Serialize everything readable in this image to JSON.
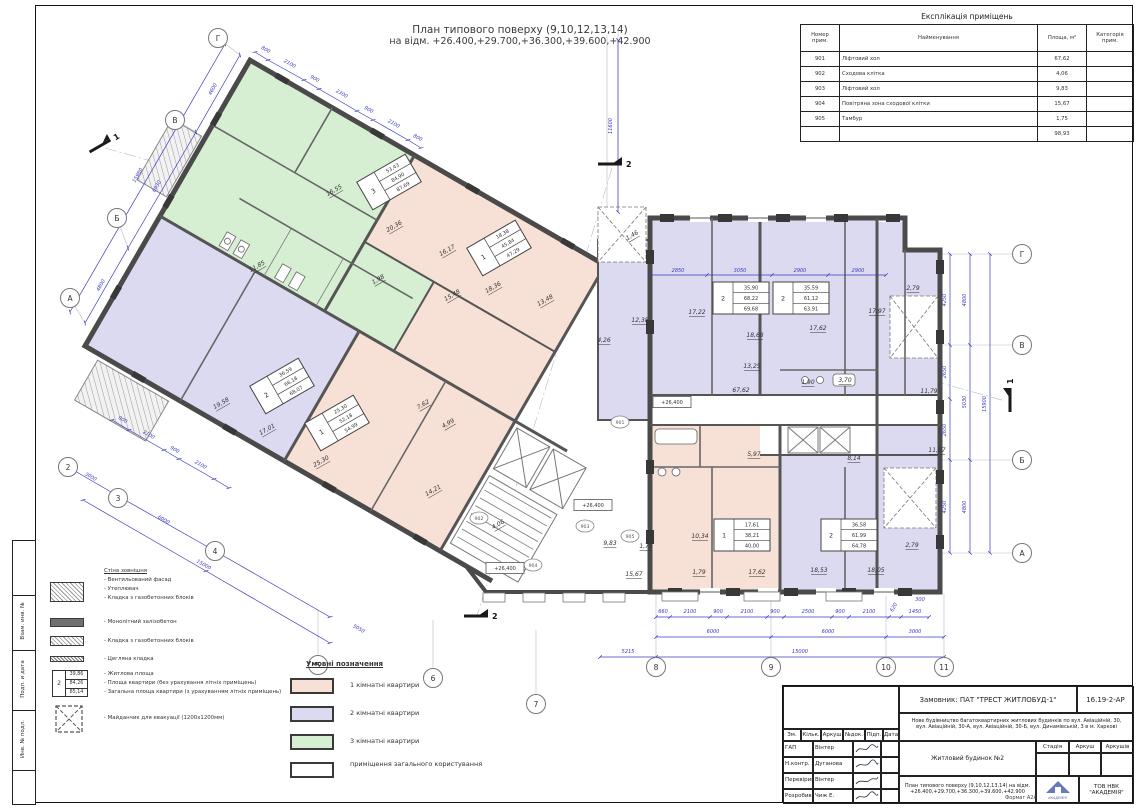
{
  "sheet": {
    "title_line1": "План типового поверху (9,10,12,13,14)",
    "title_line2": "на відм. +26.400,+29.700,+36.300,+39.600,+42.900"
  },
  "colors": {
    "one_room": "#f7e1d6",
    "two_room": "#dcdaf0",
    "three_room": "#d6efd2",
    "common": "#ffffff",
    "dimension": "#3a3ac0"
  },
  "explication": {
    "title": "Експлікація приміщень",
    "headers": [
      "Номер прим.",
      "Найменування",
      "Площа, м²",
      "Категорія прим."
    ],
    "rows": [
      {
        "num": "901",
        "name": "Ліфтовий хол",
        "area": "67,62",
        "cat": ""
      },
      {
        "num": "902",
        "name": "Сходова клітка",
        "area": "4,06",
        "cat": ""
      },
      {
        "num": "903",
        "name": "Ліфтовий хол",
        "area": "9,83",
        "cat": ""
      },
      {
        "num": "904",
        "name": "Повітряна зона сходової клітки",
        "area": "15,67",
        "cat": ""
      },
      {
        "num": "905",
        "name": "Тамбур",
        "area": "1,75",
        "cat": ""
      }
    ],
    "total": "98,93"
  },
  "wall_legend": {
    "heading": "Стіна зовнішня",
    "facade_lines": [
      "- Вентильований фасад",
      "- Утеплювач",
      "- Кладка з газобетонних блоків"
    ],
    "monolith": "- Монолітний залізобетон",
    "masonry": "- Кладка з газобетонних блоків",
    "brick": "- Цегляна кладка",
    "area_lines": [
      "- Житлова площа",
      "- Площа квартири (без урахування літніх приміщень)",
      "- Загальна площа квартири (з урахуванням літніх приміщень)"
    ],
    "evac": "- Майданчик для евакуації (1200х1200мм)",
    "sample_box": {
      "num": "2",
      "values": [
        "39,86",
        "84,26",
        "85,14"
      ]
    }
  },
  "area_legend": {
    "title": "Умовні позначення",
    "items": [
      {
        "label": "1 кімнатні квартири",
        "color": "#f7e1d6"
      },
      {
        "label": "2 кімнатні квартири",
        "color": "#dcdaf0"
      },
      {
        "label": "3 кімнатні квартири",
        "color": "#d6efd2"
      },
      {
        "label": "приміщення загального користування",
        "color": "#ffffff"
      }
    ]
  },
  "side_labels": [
    "Взам. инв. №",
    "Подп. и дата",
    "Инв. № подл."
  ],
  "title_block": {
    "customer": "Замовник: ПАТ \"ТРЕСТ ЖИТЛОБУД-1\"",
    "doc_code": "16.19-2-АР",
    "project_line1": "Нове будівництво багатоквартирних житлових будинків по вул. Авіаційній, 30,",
    "project_line2": "вул. Авіаційній, 30-А, вул. Авіаційній, 30-Б, вул. Динамівській, 3 в м. Харкові",
    "building": "Житловий будинок №2",
    "drawing_line1": "План типового поверху (9,10,12,13,14) на відм.",
    "drawing_line2": "+26.400,+29.700,+36.300,+39.600,+42.900",
    "org": "ТОВ НВК \"АКАДЕМІЯ\"",
    "logo_text": "АКАДЕМІЯ",
    "format": "Формат А2А",
    "stage_headers": [
      "Стадія",
      "Аркуш",
      "Аркушів"
    ],
    "rev_headers": [
      "Зм.",
      "Кільк.",
      "Аркуш",
      "№док.",
      "Підп.",
      "Дата"
    ],
    "signers": [
      {
        "role": "ГАП",
        "name": "Вінтер"
      },
      {
        "role": "Н.контр.",
        "name": "Дуганова"
      },
      {
        "role": "Перевірив",
        "name": "Вінтер"
      },
      {
        "role": "Розробив",
        "name": "Чиж Е."
      }
    ]
  },
  "plan": {
    "apartment_boxes": [
      {
        "num": "3",
        "values": [
          "53,43",
          "84,90",
          "87,69"
        ],
        "x": 389,
        "y": 182,
        "r": -30
      },
      {
        "num": "1",
        "values": [
          "18,38",
          "45,84",
          "47,29"
        ],
        "x": 499,
        "y": 248,
        "r": -30
      },
      {
        "num": "2",
        "values": [
          "36,59",
          "66,18",
          "68,07"
        ],
        "x": 282,
        "y": 386,
        "r": -30
      },
      {
        "num": "1",
        "values": [
          "25,30",
          "52,18",
          "54,99"
        ],
        "x": 337,
        "y": 423,
        "r": -30
      },
      {
        "num": "2",
        "values": [
          "35,90",
          "68,22",
          "69,68"
        ],
        "x": 741,
        "y": 298,
        "r": 0
      },
      {
        "num": "2",
        "values": [
          "35,59",
          "61,12",
          "63,91"
        ],
        "x": 801,
        "y": 298,
        "r": 0
      },
      {
        "num": "1",
        "values": [
          "17,61",
          "38,21",
          "40,00"
        ],
        "x": 742,
        "y": 535,
        "r": 0
      },
      {
        "num": "2",
        "values": [
          "36,58",
          "61,99",
          "64,78"
        ],
        "x": 849,
        "y": 535,
        "r": 0
      }
    ],
    "room_labels": [
      {
        "t": "16,55",
        "x": 335,
        "y": 192,
        "r": -30
      },
      {
        "t": "20,36",
        "x": 395,
        "y": 228,
        "r": -30
      },
      {
        "t": "16,17",
        "x": 448,
        "y": 252,
        "r": -30
      },
      {
        "t": "18,36",
        "x": 494,
        "y": 289,
        "r": -30
      },
      {
        "t": "11,85",
        "x": 258,
        "y": 268,
        "r": -30
      },
      {
        "t": "19,58",
        "x": 222,
        "y": 405,
        "r": -30
      },
      {
        "t": "17,01",
        "x": 268,
        "y": 431,
        "r": -30
      },
      {
        "t": "25,30",
        "x": 322,
        "y": 463,
        "r": -30
      },
      {
        "t": "7,62",
        "x": 424,
        "y": 406,
        "r": -30
      },
      {
        "t": "4,99",
        "x": 449,
        "y": 425,
        "r": -30
      },
      {
        "t": "14,21",
        "x": 434,
        "y": 492,
        "r": -30
      },
      {
        "t": "13,48",
        "x": 546,
        "y": 302,
        "r": -30
      },
      {
        "t": "15,48",
        "x": 453,
        "y": 297,
        "r": -30
      },
      {
        "t": "1,98",
        "x": 379,
        "y": 281,
        "r": -30
      },
      {
        "t": "12,38",
        "x": 640,
        "y": 322,
        "r": 0
      },
      {
        "t": "4,26",
        "x": 604,
        "y": 342,
        "r": 0
      },
      {
        "t": "1,46",
        "x": 633,
        "y": 237,
        "r": -30
      },
      {
        "t": "4,06",
        "x": 499,
        "y": 526,
        "r": -30
      },
      {
        "t": "9,83",
        "x": 610,
        "y": 545,
        "r": 0
      },
      {
        "t": "1,75",
        "x": 646,
        "y": 548,
        "r": 0
      },
      {
        "t": "15,67",
        "x": 634,
        "y": 576,
        "r": 0
      },
      {
        "t": "67,62",
        "x": 741,
        "y": 392,
        "r": 0
      },
      {
        "t": "17,22",
        "x": 697,
        "y": 314,
        "r": 0
      },
      {
        "t": "18,68",
        "x": 755,
        "y": 337,
        "r": 0
      },
      {
        "t": "17,62",
        "x": 818,
        "y": 330,
        "r": 0
      },
      {
        "t": "17,97",
        "x": 877,
        "y": 313,
        "r": 0
      },
      {
        "t": "2,79",
        "x": 913,
        "y": 290,
        "r": 0
      },
      {
        "t": "13,25",
        "x": 752,
        "y": 368,
        "r": 0
      },
      {
        "t": "1,90",
        "x": 808,
        "y": 384,
        "r": 0
      },
      {
        "t": "3,70",
        "x": 845,
        "y": 382,
        "r": 0
      },
      {
        "t": "8,14",
        "x": 854,
        "y": 460,
        "r": 0
      },
      {
        "t": "11,79",
        "x": 929,
        "y": 393,
        "r": 0
      },
      {
        "t": "5,97",
        "x": 754,
        "y": 456,
        "r": 0
      },
      {
        "t": "10,34",
        "x": 700,
        "y": 538,
        "r": 0
      },
      {
        "t": "17,62",
        "x": 757,
        "y": 574,
        "r": 0
      },
      {
        "t": "1,79",
        "x": 699,
        "y": 574,
        "r": 0
      },
      {
        "t": "18,53",
        "x": 819,
        "y": 572,
        "r": 0
      },
      {
        "t": "18,05",
        "x": 876,
        "y": 572,
        "r": 0
      },
      {
        "t": "2,79",
        "x": 912,
        "y": 547,
        "r": 0
      },
      {
        "t": "11,67",
        "x": 937,
        "y": 452,
        "r": 0
      }
    ],
    "dim_labels": [
      {
        "t": "660",
        "x": 663,
        "y": 613,
        "r": 0
      },
      {
        "t": "2100",
        "x": 690,
        "y": 613,
        "r": 0
      },
      {
        "t": "900",
        "x": 718,
        "y": 613,
        "r": 0
      },
      {
        "t": "2100",
        "x": 747,
        "y": 613,
        "r": 0
      },
      {
        "t": "900",
        "x": 775,
        "y": 613,
        "r": 0
      },
      {
        "t": "2500",
        "x": 808,
        "y": 613,
        "r": 0
      },
      {
        "t": "900",
        "x": 840,
        "y": 613,
        "r": 0
      },
      {
        "t": "2100",
        "x": 869,
        "y": 613,
        "r": 0
      },
      {
        "t": "620",
        "x": 895,
        "y": 608,
        "r": -60
      },
      {
        "t": "1450",
        "x": 915,
        "y": 613,
        "r": 0
      },
      {
        "t": "300",
        "x": 920,
        "y": 601,
        "r": 0
      },
      {
        "t": "6000",
        "x": 713,
        "y": 633,
        "r": 0
      },
      {
        "t": "6000",
        "x": 828,
        "y": 633,
        "r": 0
      },
      {
        "t": "3000",
        "x": 915,
        "y": 633,
        "r": 0
      },
      {
        "t": "5215",
        "x": 628,
        "y": 653,
        "r": 0
      },
      {
        "t": "15000",
        "x": 800,
        "y": 653,
        "r": 0
      },
      {
        "t": "4250",
        "x": 946,
        "y": 300,
        "r": -90
      },
      {
        "t": "2650",
        "x": 946,
        "y": 372,
        "r": -90
      },
      {
        "t": "2650",
        "x": 946,
        "y": 430,
        "r": -90
      },
      {
        "t": "4250",
        "x": 946,
        "y": 507,
        "r": -90
      },
      {
        "t": "4800",
        "x": 966,
        "y": 300,
        "r": -90
      },
      {
        "t": "5030",
        "x": 966,
        "y": 402,
        "r": -90
      },
      {
        "t": "4800",
        "x": 966,
        "y": 507,
        "r": -90
      },
      {
        "t": "15900",
        "x": 986,
        "y": 404,
        "r": -90
      },
      {
        "t": "4600",
        "x": 214,
        "y": 90,
        "r": -60
      },
      {
        "t": "6930",
        "x": 158,
        "y": 187,
        "r": -60
      },
      {
        "t": "4800",
        "x": 102,
        "y": 286,
        "r": -60
      },
      {
        "t": "15980",
        "x": 139,
        "y": 176,
        "r": -60
      },
      {
        "t": "3000",
        "x": 90,
        "y": 478,
        "r": 30
      },
      {
        "t": "6000",
        "x": 163,
        "y": 521,
        "r": 30
      },
      {
        "t": "15000",
        "x": 203,
        "y": 566,
        "r": 30
      },
      {
        "t": "5050",
        "x": 358,
        "y": 630,
        "r": 30
      },
      {
        "t": "900",
        "x": 122,
        "y": 421,
        "r": 30
      },
      {
        "t": "2100",
        "x": 148,
        "y": 436,
        "r": 30
      },
      {
        "t": "900",
        "x": 174,
        "y": 451,
        "r": 30
      },
      {
        "t": "2100",
        "x": 200,
        "y": 466,
        "r": 30
      },
      {
        "t": "800",
        "x": 265,
        "y": 51,
        "r": 30
      },
      {
        "t": "2100",
        "x": 289,
        "y": 65,
        "r": 30
      },
      {
        "t": "900",
        "x": 314,
        "y": 80,
        "r": 30
      },
      {
        "t": "2300",
        "x": 341,
        "y": 95,
        "r": 30
      },
      {
        "t": "900",
        "x": 368,
        "y": 111,
        "r": 30
      },
      {
        "t": "2100",
        "x": 393,
        "y": 125,
        "r": 30
      },
      {
        "t": "800",
        "x": 417,
        "y": 139,
        "r": 30
      },
      {
        "t": "11600",
        "x": 612,
        "y": 126,
        "r": -90
      },
      {
        "t": "2850",
        "x": 678,
        "y": 272,
        "r": 0
      },
      {
        "t": "3050",
        "x": 740,
        "y": 272,
        "r": 0
      },
      {
        "t": "2900",
        "x": 800,
        "y": 272,
        "r": 0
      },
      {
        "t": "2900",
        "x": 858,
        "y": 272,
        "r": 0
      }
    ],
    "axis_bubbles": [
      {
        "t": "Г",
        "x": 218,
        "y": 38
      },
      {
        "t": "В",
        "x": 175,
        "y": 120
      },
      {
        "t": "Б",
        "x": 117,
        "y": 218
      },
      {
        "t": "А",
        "x": 70,
        "y": 298
      },
      {
        "t": "2",
        "x": 68,
        "y": 467
      },
      {
        "t": "3",
        "x": 118,
        "y": 498
      },
      {
        "t": "4",
        "x": 215,
        "y": 551
      },
      {
        "t": "5",
        "x": 318,
        "y": 665
      },
      {
        "t": "6",
        "x": 433,
        "y": 678
      },
      {
        "t": "7",
        "x": 536,
        "y": 704
      },
      {
        "t": "8",
        "x": 656,
        "y": 667
      },
      {
        "t": "9",
        "x": 771,
        "y": 667
      },
      {
        "t": "10",
        "x": 886,
        "y": 667
      },
      {
        "t": "11",
        "x": 944,
        "y": 667
      },
      {
        "t": "Г",
        "x": 1022,
        "y": 254
      },
      {
        "t": "В",
        "x": 1022,
        "y": 345
      },
      {
        "t": "Б",
        "x": 1022,
        "y": 460
      },
      {
        "t": "А",
        "x": 1022,
        "y": 553
      }
    ],
    "room_circles": [
      {
        "t": "901",
        "x": 620,
        "y": 422
      },
      {
        "t": "902",
        "x": 479,
        "y": 518
      },
      {
        "t": "903",
        "x": 585,
        "y": 526
      },
      {
        "t": "904",
        "x": 533,
        "y": 565
      },
      {
        "t": "905",
        "x": 630,
        "y": 536
      }
    ],
    "elevation_marks": [
      {
        "t": "+26,400",
        "x": 672,
        "y": 402
      },
      {
        "t": "+26,400",
        "x": 593,
        "y": 505
      },
      {
        "t": "+26,400",
        "x": 505,
        "y": 568
      }
    ],
    "section_marks": [
      {
        "t": "1",
        "x": 100,
        "y": 146,
        "r": -30
      },
      {
        "t": "1",
        "x": 1010,
        "y": 400,
        "r": -90
      },
      {
        "t": "2",
        "x": 610,
        "y": 164,
        "r": 0
      },
      {
        "t": "2",
        "x": 476,
        "y": 616,
        "r": 0
      }
    ]
  }
}
